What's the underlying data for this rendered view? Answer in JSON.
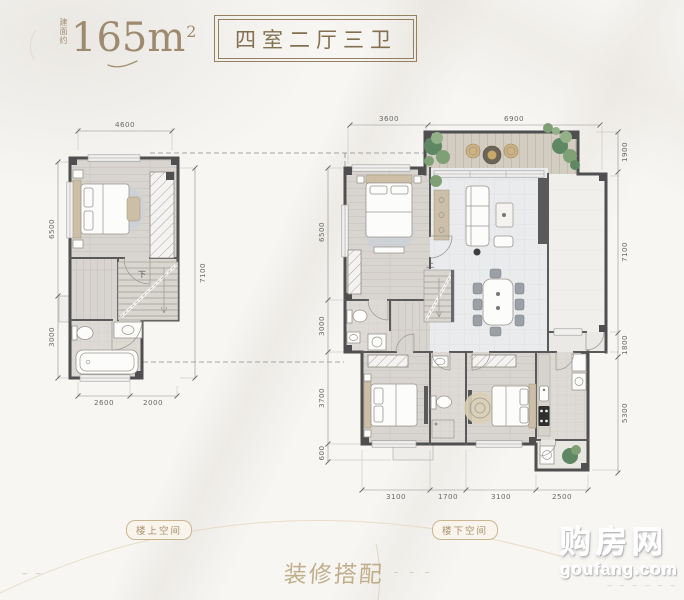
{
  "page": {
    "area_prefix": "建面约",
    "area_value": "165m",
    "area_sup": "2",
    "rooms_label": "四室二厅三卫"
  },
  "plans": {
    "upper": {
      "tag_label": "楼上空间",
      "stair_label": "下",
      "dims": {
        "top": [
          "4600"
        ],
        "left": [
          "6500",
          "3000"
        ],
        "right": [
          "7100"
        ],
        "bottom": [
          "2600",
          "2000"
        ]
      }
    },
    "lower": {
      "tag_label": "楼下空间",
      "stair_label": "上",
      "dims": {
        "top": [
          "3600",
          "6900"
        ],
        "left": [
          "6500",
          "3000",
          "3700",
          "600"
        ],
        "right": [
          "1900",
          "7100",
          "1800",
          "5300"
        ],
        "bottom": [
          "3100",
          "1700",
          "3100",
          "2500"
        ]
      }
    }
  },
  "footer": {
    "deco_text": "装修搭配",
    "deco_marks": "– – –",
    "left_marks": "– –"
  },
  "watermark": {
    "brand": "购房网",
    "site": "goufang.com",
    "dashes": "– – – – – –"
  },
  "colors": {
    "accent_gold": "#9a8565",
    "wall_dark": "#4f4f4f",
    "floor_wood": "#d8d4cf",
    "floor_tile": "#e9ebed",
    "plant_green": "#7fa075",
    "watermark_white": "#ffffff"
  }
}
